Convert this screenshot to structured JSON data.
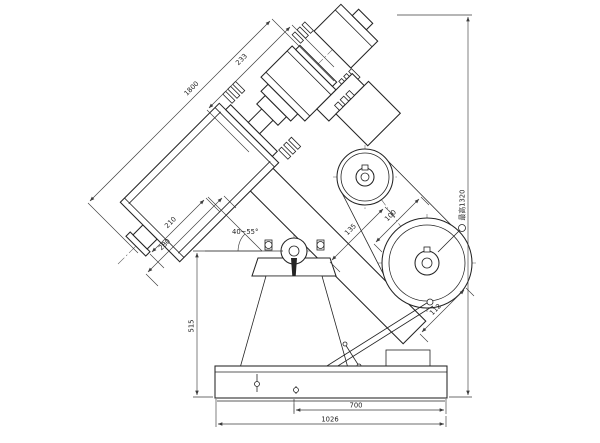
{
  "meta": {
    "kind": "engineering line drawing",
    "subject": "inclined drum mixer / mill, side elevation with dimensions"
  },
  "colors": {
    "background": "#ffffff",
    "line": "#242424",
    "dimension_line": "#3c3c3c"
  },
  "labels": {
    "dim_axis_upper": "233",
    "dim_axis_total": "1800",
    "dim_total_height": "最高1320",
    "dim_pivot_height": "515",
    "dim_base_right": "700",
    "dim_base_total": "1026",
    "angle_range": "40~55°",
    "dim_drum_a": "210",
    "dim_drum_b": "280",
    "dim_pulley_a": "135",
    "dim_pulley_b": "100",
    "dim_pulley_c": "112"
  }
}
